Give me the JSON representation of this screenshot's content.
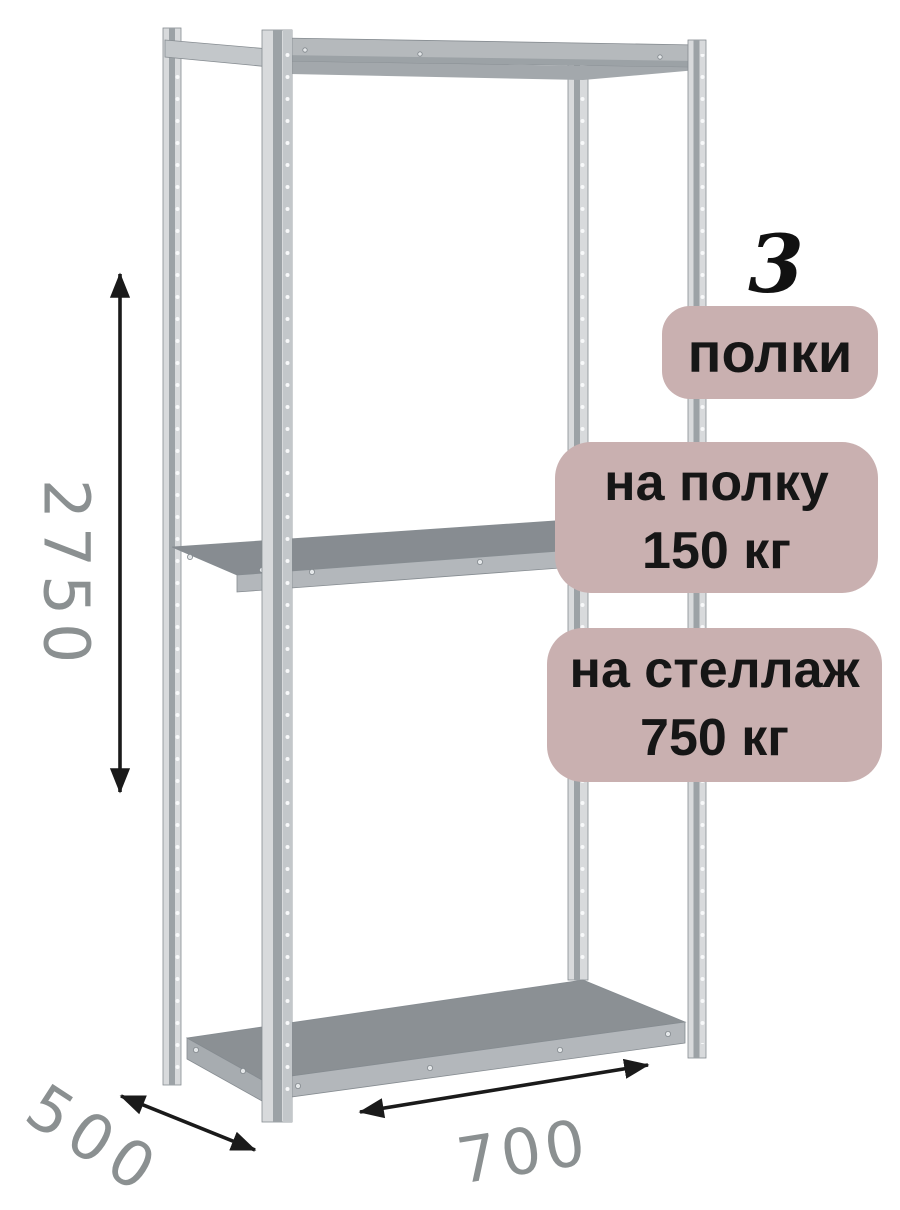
{
  "annotations": {
    "shelf_count": {
      "number": "3",
      "label": "полки"
    },
    "per_shelf_load": {
      "line1": "на полку",
      "line2": "150 кг"
    },
    "per_rack_load": {
      "line1": "на стеллаж",
      "line2": "750 кг"
    }
  },
  "dimensions": {
    "height_mm": "2750",
    "depth_mm": "500",
    "width_mm": "700"
  },
  "structure": {
    "shelves_visible": 3,
    "posts_visible": 4
  },
  "colors": {
    "badge_bg": "#c9b0b0",
    "badge_text": "#161616",
    "count_text": "#111111",
    "dim_text": "#8b9091",
    "arrow": "#1a1a1a",
    "metal_light": "#d8dadc",
    "metal_mid": "#b5b9bc",
    "metal_dark": "#9ca2a6",
    "metal_shadow": "#a3a8ac",
    "beam_light": "#c3c7ca",
    "shelf_top": "#878c91",
    "shelf_top2": "#8b9094",
    "fascia": "#b3b7bb",
    "fascia_side": "#a7acb0",
    "outline": "#868c91",
    "hole": "#f8f9fa"
  }
}
